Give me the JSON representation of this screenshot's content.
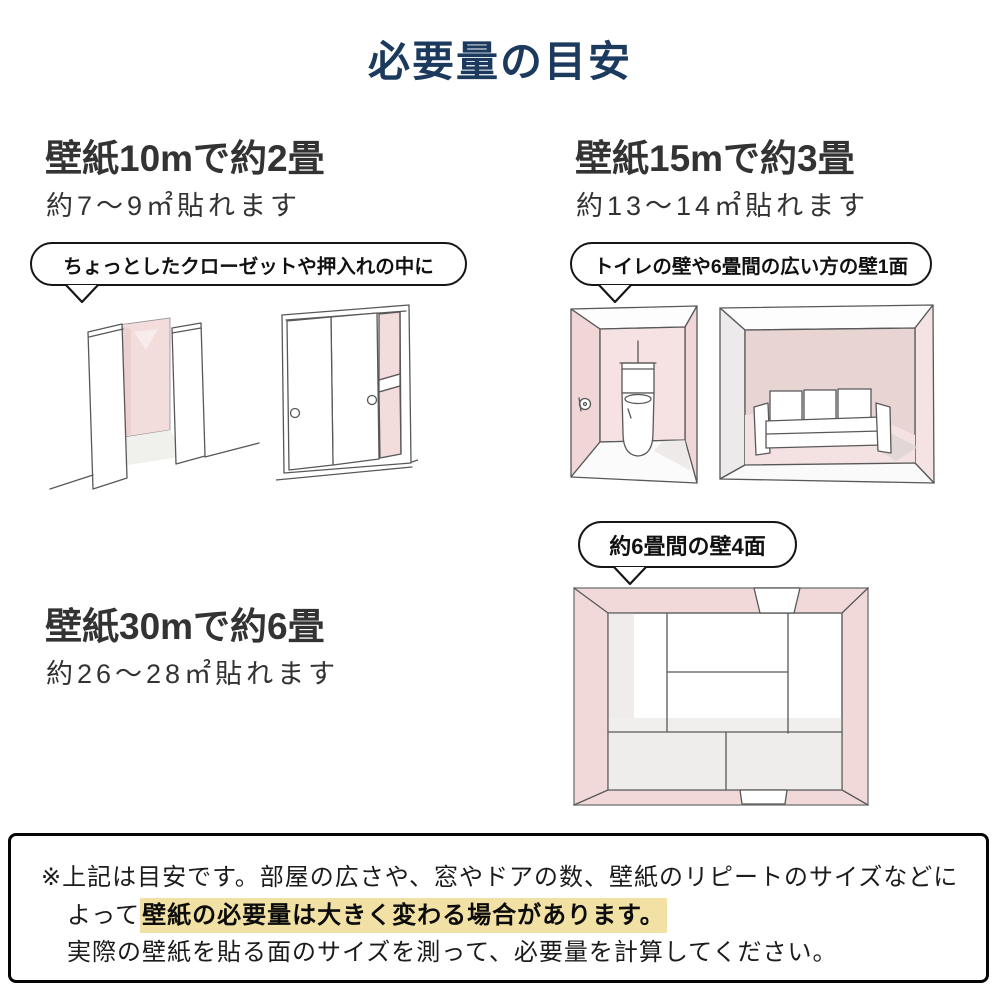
{
  "title": "必要量の目安",
  "sections": {
    "s10m": {
      "heading": "壁紙10mで約2畳",
      "subtext": "約7〜9㎡貼れます",
      "bubble": "ちょっとしたクローゼットや押入れの中に"
    },
    "s15m": {
      "heading": "壁紙15mで約3畳",
      "subtext": "約13〜14㎡貼れます",
      "bubble": "トイレの壁や6畳間の広い方の壁1面"
    },
    "s30m": {
      "heading": "壁紙30mで約6畳",
      "subtext": "約26〜28㎡貼れます",
      "bubble": "約6畳間の壁4面"
    }
  },
  "note": {
    "line1": "※上記は目安です。部屋の広さや、窓やドアの数、壁紙のリピートのサイズなどに",
    "line2_prefix": "よって",
    "line2_highlight": "壁紙の必要量は大きく変わる場合があります。",
    "line3": "実際の壁紙を貼る面のサイズを測って、必要量を計算してください。"
  },
  "colors": {
    "title_navy": "#1b3a5e",
    "body_text": "#333333",
    "bubble_border": "#161616",
    "wall_pink": "#f2dcdc",
    "wall_pink_light": "#f6e2e2",
    "highlight_yellow": "#f1e1a5"
  }
}
